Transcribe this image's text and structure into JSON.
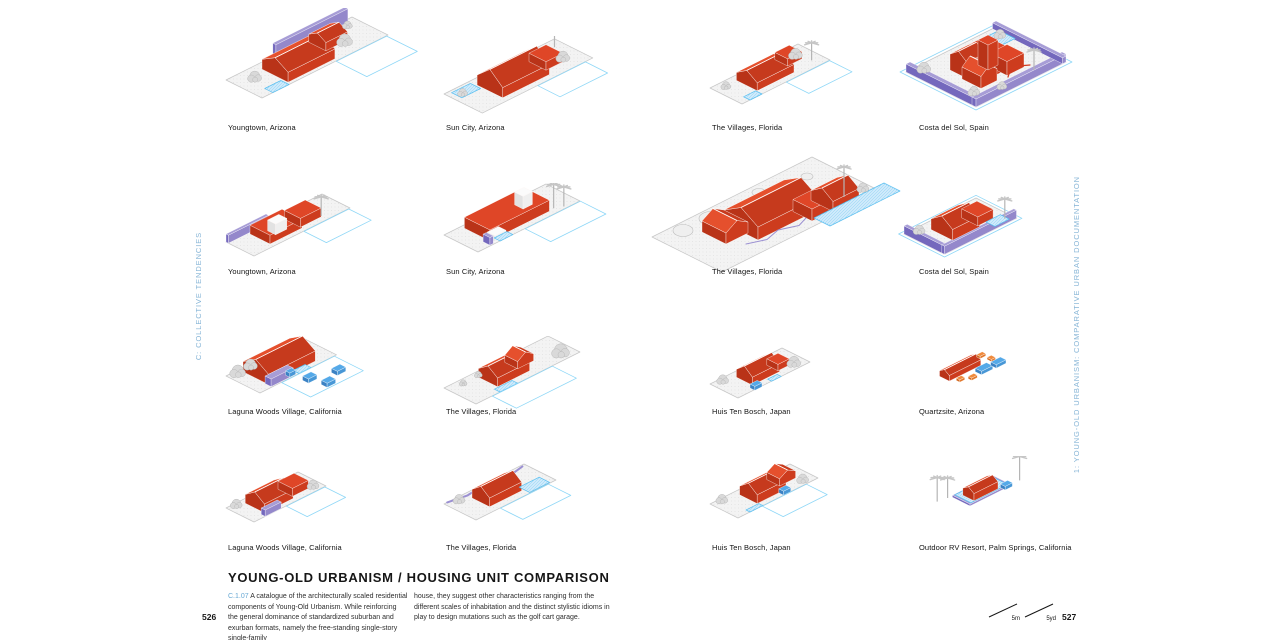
{
  "page_numbers": {
    "left": "526",
    "right": "527"
  },
  "margins": {
    "left_label": "C: COLLECTIVE TENDENCIES",
    "right_label": "1: YOUNG-OLD URBANISM: COMPARATIVE URBAN DOCUMENTATION"
  },
  "title_block": {
    "title": "YOUNG-OLD URBANISM / HOUSING UNIT COMPARISON",
    "section_code": "C.1.07",
    "paragraph_col1": "A catalogue of the architecturally scaled residential components of Young-Old Urbanism. While reinforcing the general dominance of standardized suburban and exurban formats, namely the free-standing single-story single-family",
    "paragraph_col2": "house, they suggest other characteristics ranging from the different scales of inhabitation and the distinct stylistic idioms in play to design mutations such as the golf cart garage."
  },
  "scale_bar": {
    "metric_label": "5m",
    "imperial_label": "5yd"
  },
  "units": [
    {
      "caption": "Youngtown, Arizona"
    },
    {
      "caption": "Sun City, Arizona"
    },
    {
      "caption": "The Villages, Florida"
    },
    {
      "caption": "Costa del Sol, Spain"
    },
    {
      "caption": "Youngtown, Arizona"
    },
    {
      "caption": "Sun City, Arizona"
    },
    {
      "caption": "The Villages, Florida"
    },
    {
      "caption": "Costa del Sol, Spain"
    },
    {
      "caption": "Laguna Woods Village, California"
    },
    {
      "caption": "The Villages, Florida"
    },
    {
      "caption": "Huis Ten Bosch, Japan"
    },
    {
      "caption": "Quartzsite, Arizona"
    },
    {
      "caption": "Laguna Woods Village, California"
    },
    {
      "caption": "The Villages, Florida"
    },
    {
      "caption": "Huis Ten Bosch, Japan"
    },
    {
      "caption": "Outdoor RV Resort, Palm Springs, California"
    }
  ],
  "colors": {
    "accent_red": "#d9402a",
    "margin_label_blue": "#85b4d6",
    "section_code_blue": "#69a9d4",
    "pool_blue": "#cfeafb",
    "outline_cyan": "#8ed7f7",
    "wall_purple": "#9185cc"
  }
}
